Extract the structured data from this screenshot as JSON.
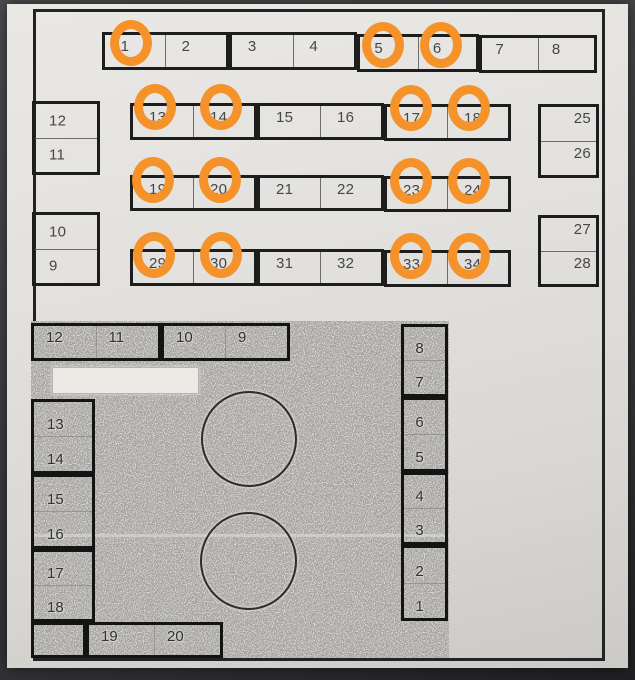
{
  "document": {
    "kind": "photographed seating chart page",
    "sections": [
      "numbered seat rows (top)",
      "photocopied floor plan (bottom)"
    ]
  },
  "colors": {
    "highlight_circle": "#f5922a",
    "paper": "#e3e1de",
    "photo_background": "#3a3a3d",
    "photocopy_gray": "#a6a4a1",
    "ink": "#1d1d1d"
  },
  "top_plan": {
    "row1": [
      {
        "label": "1",
        "circled": true
      },
      {
        "label": "2",
        "circled": false
      },
      {
        "label": "3",
        "circled": false
      },
      {
        "label": "4",
        "circled": false
      },
      {
        "label": "5",
        "circled": true
      },
      {
        "label": "6",
        "circled": true
      },
      {
        "label": "7",
        "circled": false
      },
      {
        "label": "8",
        "circled": false
      }
    ],
    "row2": [
      {
        "label": "13",
        "circled": true
      },
      {
        "label": "14",
        "circled": true
      },
      {
        "label": "15",
        "circled": false
      },
      {
        "label": "16",
        "circled": false
      },
      {
        "label": "17",
        "circled": true
      },
      {
        "label": "18",
        "circled": true
      }
    ],
    "row3": [
      {
        "label": "19",
        "circled": true
      },
      {
        "label": "20",
        "circled": true
      },
      {
        "label": "21",
        "circled": false
      },
      {
        "label": "22",
        "circled": false
      },
      {
        "label": "23",
        "circled": true
      },
      {
        "label": "24",
        "circled": true
      }
    ],
    "row4": [
      {
        "label": "29",
        "circled": true
      },
      {
        "label": "30",
        "circled": true
      },
      {
        "label": "31",
        "circled": false
      },
      {
        "label": "32",
        "circled": false
      },
      {
        "label": "33",
        "circled": true
      },
      {
        "label": "34",
        "circled": true
      }
    ],
    "left_stacks": [
      {
        "top": "12",
        "bottom": "11"
      },
      {
        "top": "10",
        "bottom": "9"
      }
    ],
    "right_stacks": [
      {
        "top": "25",
        "bottom": "26"
      },
      {
        "top": "27",
        "bottom": "28"
      }
    ]
  },
  "floor_plan": {
    "top_row": [
      {
        "a": "12",
        "b": "11"
      },
      {
        "a": "10",
        "b": "9"
      }
    ],
    "left_col": [
      {
        "a": "13",
        "b": "14"
      },
      {
        "a": "15",
        "b": "16"
      },
      {
        "a": "17",
        "b": "18"
      }
    ],
    "right_col": [
      {
        "a": "8",
        "b": "7"
      },
      {
        "a": "6",
        "b": "5"
      },
      {
        "a": "4",
        "b": "3"
      },
      {
        "a": "2",
        "b": "1"
      }
    ],
    "bottom_row": {
      "a": "19",
      "b": "20"
    },
    "label_box_text": "",
    "round_tables": 2
  }
}
